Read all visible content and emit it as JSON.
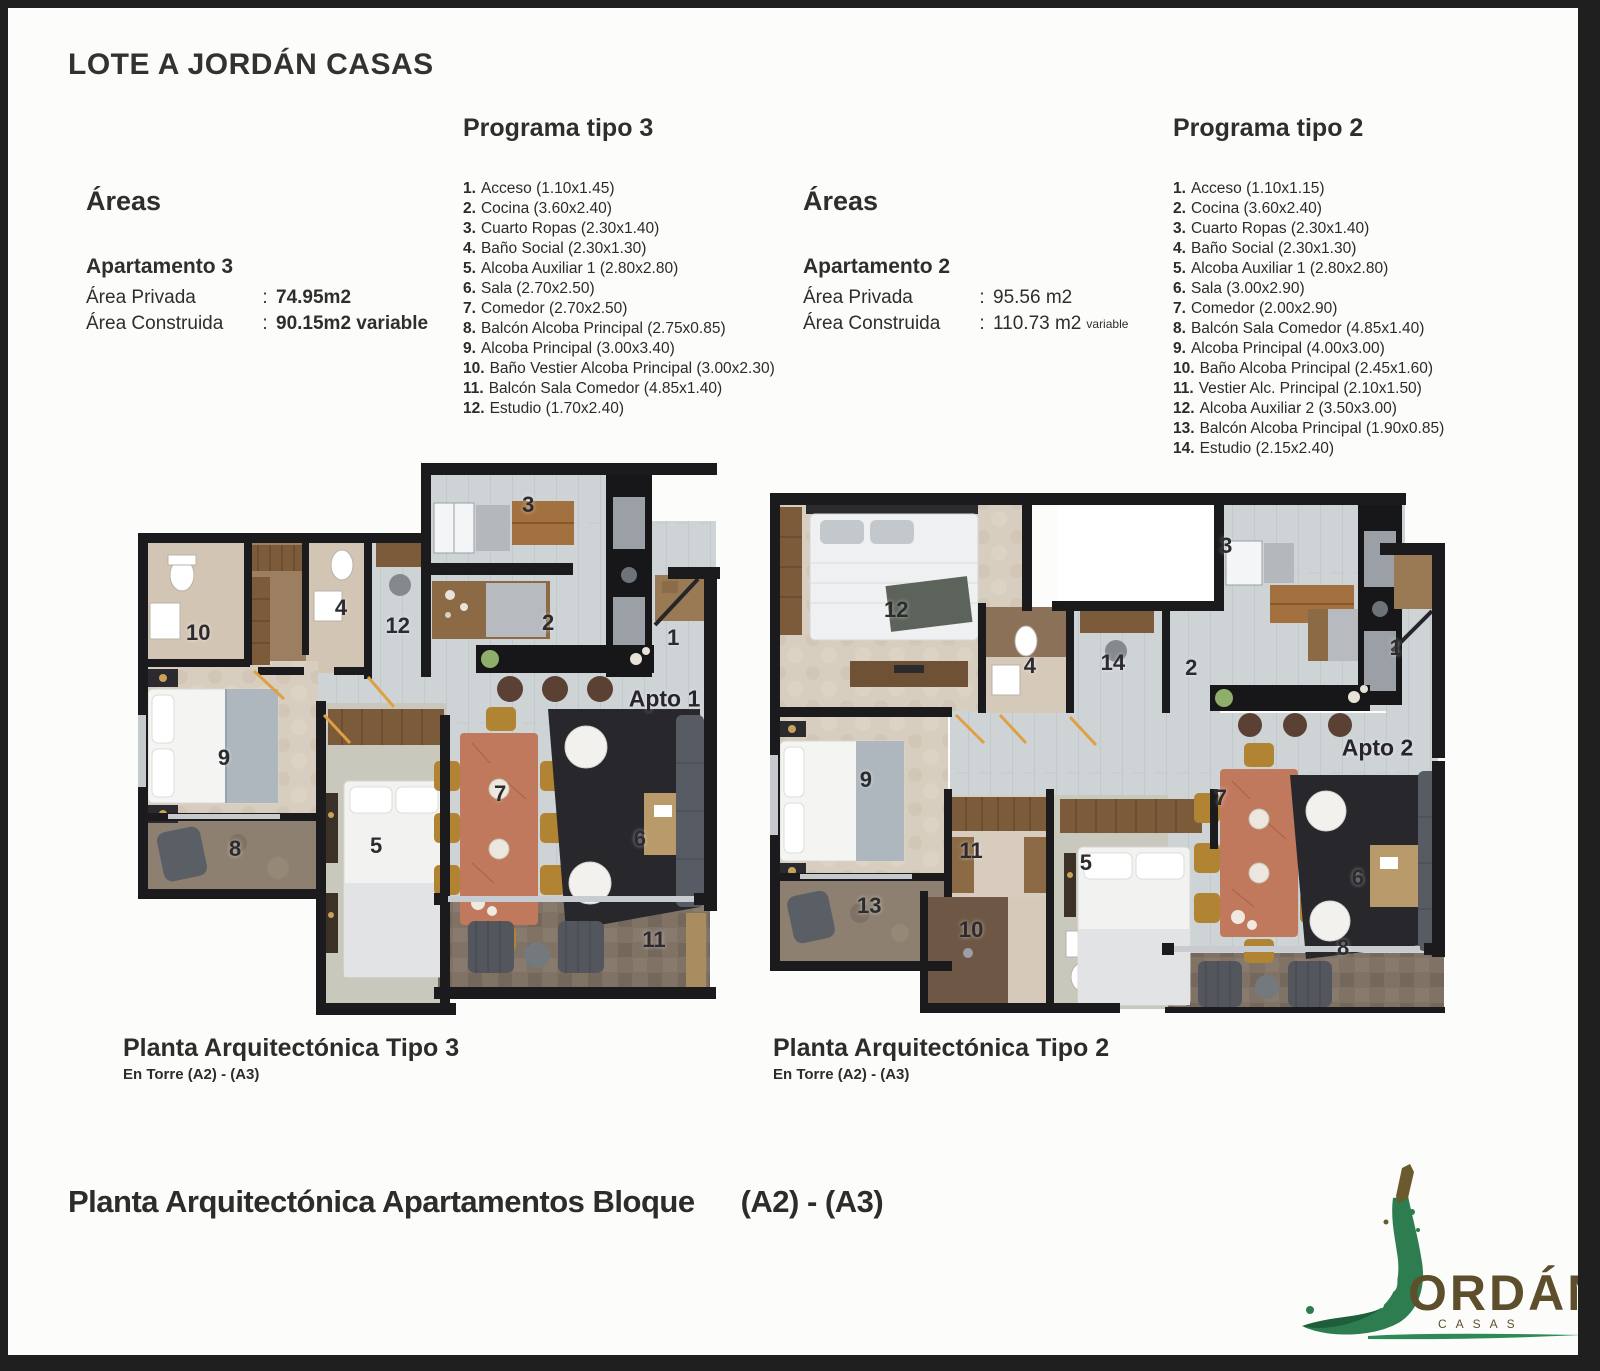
{
  "page": {
    "title": "LOTE A JORDÁN CASAS",
    "bottom_title": "Planta Arquitectónica Apartamentos Bloque",
    "bottom_title_suffix": "(A2) - (A3)"
  },
  "programa3": {
    "heading": "Programa tipo 3",
    "items": [
      {
        "num": "1.",
        "text": "Acceso (1.10x1.45)"
      },
      {
        "num": "2.",
        "text": "Cocina (3.60x2.40)"
      },
      {
        "num": "3.",
        "text": "Cuarto Ropas (2.30x1.40)"
      },
      {
        "num": "4.",
        "text": "Baño Social (2.30x1.30)"
      },
      {
        "num": "5.",
        "text": "Alcoba Auxiliar 1 (2.80x2.80)"
      },
      {
        "num": "6.",
        "text": "Sala (2.70x2.50)"
      },
      {
        "num": "7.",
        "text": "Comedor (2.70x2.50)"
      },
      {
        "num": "8.",
        "text": "Balcón Alcoba Principal (2.75x0.85)"
      },
      {
        "num": "9.",
        "text": "Alcoba Principal (3.00x3.40)"
      },
      {
        "num": "10.",
        "text": "Baño Vestier Alcoba Principal (3.00x2.30)"
      },
      {
        "num": "11.",
        "text": "Balcón Sala Comedor (4.85x1.40)"
      },
      {
        "num": "12.",
        "text": "Estudio (1.70x2.40)"
      }
    ]
  },
  "programa2": {
    "heading": "Programa tipo 2",
    "items": [
      {
        "num": "1.",
        "text": "Acceso (1.10x1.15)"
      },
      {
        "num": "2.",
        "text": "Cocina (3.60x2.40)"
      },
      {
        "num": "3.",
        "text": "Cuarto Ropas (2.30x1.40)"
      },
      {
        "num": "4.",
        "text": "Baño Social (2.30x1.30)"
      },
      {
        "num": "5.",
        "text": "Alcoba Auxiliar 1 (2.80x2.80)"
      },
      {
        "num": "6.",
        "text": "Sala (3.00x2.90)"
      },
      {
        "num": "7.",
        "text": "Comedor (2.00x2.90)"
      },
      {
        "num": "8.",
        "text": "Balcón Sala Comedor (4.85x1.40)"
      },
      {
        "num": "9.",
        "text": "Alcoba Principal (4.00x3.00)"
      },
      {
        "num": "10.",
        "text": "Baño Alcoba Principal (2.45x1.60)"
      },
      {
        "num": "11.",
        "text": "Vestier Alc. Principal (2.10x1.50)"
      },
      {
        "num": "12.",
        "text": "Alcoba Auxiliar 2 (3.50x3.00)"
      },
      {
        "num": "13.",
        "text": "Balcón Alcoba Principal (1.90x0.85)"
      },
      {
        "num": "14.",
        "text": "Estudio (2.15x2.40)"
      }
    ]
  },
  "areas3": {
    "heading": "Áreas",
    "subheading": "Apartamento 3",
    "rows": [
      {
        "label": "Área Privada",
        "sep": ":",
        "value": "74.95m2"
      },
      {
        "label": "Área Construida",
        "sep": ":",
        "value": "90.15m2 variable"
      }
    ]
  },
  "areas2": {
    "heading": "Áreas",
    "subheading": "Apartamento 2",
    "rows": [
      {
        "label": "Área Privada",
        "sep": ":",
        "value": "95.56 m2"
      },
      {
        "label": "Área Construida",
        "sep": ":",
        "value": "110.73 m2",
        "note": "variable"
      }
    ]
  },
  "plan1": {
    "caption": "Planta Arquitectónica Tipo 3",
    "subcaption": "En Torre  (A2) - (A3)",
    "labels": [
      {
        "t": "3",
        "x": 66.7,
        "y": 7.6
      },
      {
        "t": "2",
        "x": 70.1,
        "y": 28.8
      },
      {
        "t": "1",
        "x": 91.5,
        "y": 31.5
      },
      {
        "t": "Apto 1",
        "x": 90.0,
        "y": 42.5,
        "cls": "big"
      },
      {
        "t": "4",
        "x": 34.7,
        "y": 26.1
      },
      {
        "t": "10",
        "x": 10.3,
        "y": 30.6
      },
      {
        "t": "12",
        "x": 44.4,
        "y": 29.4
      },
      {
        "t": "9",
        "x": 14.7,
        "y": 53.2
      },
      {
        "t": "5",
        "x": 40.7,
        "y": 69.0
      },
      {
        "t": "7",
        "x": 61.9,
        "y": 59.6
      },
      {
        "t": "6",
        "x": 85.8,
        "y": 67.7
      },
      {
        "t": "8",
        "x": 16.6,
        "y": 69.5
      },
      {
        "t": "11",
        "x": 88.2,
        "y": 86.0
      }
    ]
  },
  "plan2": {
    "caption": "Planta Arquitectónica Tipo 2",
    "subcaption": "En Torre  (A2) - (A3)",
    "labels": [
      {
        "t": "12",
        "x": 18.7,
        "y": 22.5
      },
      {
        "t": "3",
        "x": 67.6,
        "y": 10.2
      },
      {
        "t": "4",
        "x": 38.5,
        "y": 33.3
      },
      {
        "t": "14",
        "x": 50.8,
        "y": 32.7
      },
      {
        "t": "2",
        "x": 62.4,
        "y": 33.7
      },
      {
        "t": "1",
        "x": 92.7,
        "y": 29.8
      },
      {
        "t": "Apto 2",
        "x": 90.0,
        "y": 49.0,
        "cls": "big"
      },
      {
        "t": "9",
        "x": 14.2,
        "y": 55.2
      },
      {
        "t": "11",
        "x": 29.8,
        "y": 68.8
      },
      {
        "t": "5",
        "x": 46.8,
        "y": 71.2
      },
      {
        "t": "7",
        "x": 66.8,
        "y": 58.7
      },
      {
        "t": "6",
        "x": 87.1,
        "y": 74.0
      },
      {
        "t": "13",
        "x": 14.7,
        "y": 79.4
      },
      {
        "t": "10",
        "x": 29.8,
        "y": 84.0
      },
      {
        "t": "8",
        "x": 84.9,
        "y": 87.5
      }
    ]
  },
  "logo": {
    "name": "ORDÁN",
    "sub": "CASAS",
    "green": "#2e7d50",
    "brown": "#5d4f2c"
  }
}
